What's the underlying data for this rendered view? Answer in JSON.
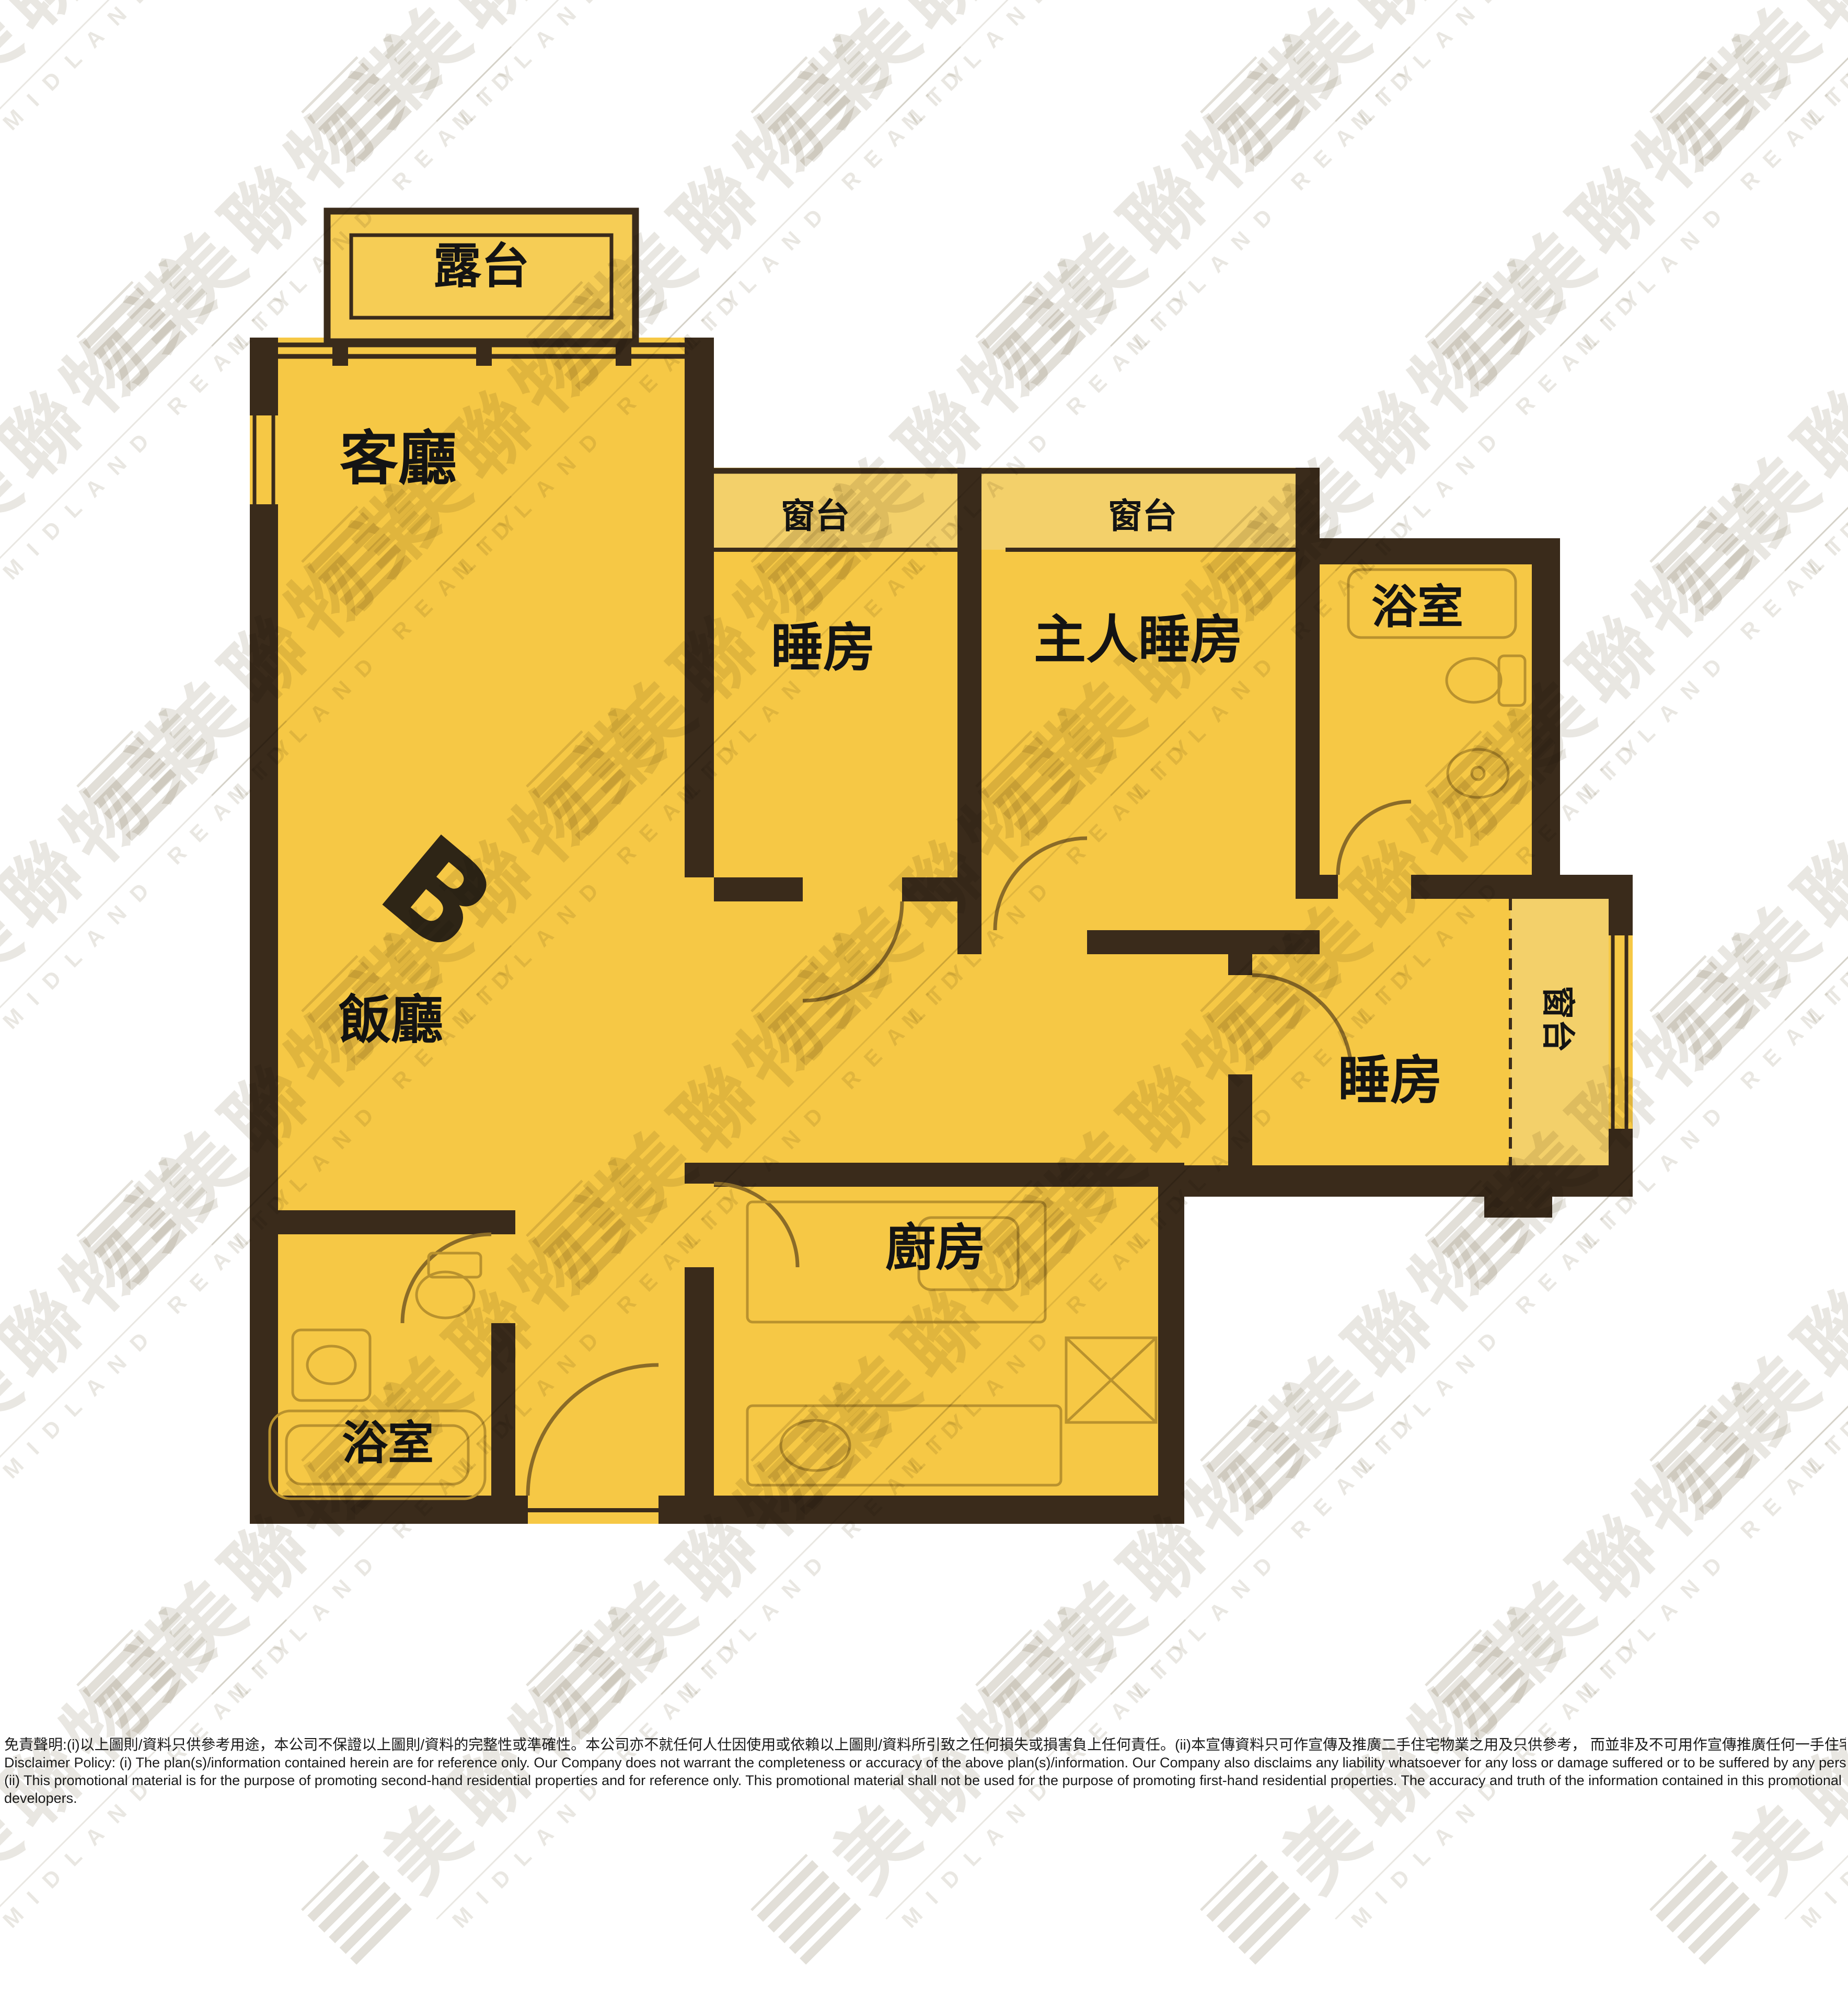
{
  "watermark": {
    "cn": "美聯物業",
    "en": "MIDLAND REALTY"
  },
  "plan_labels": {
    "balcony": "露台",
    "living": "客廳",
    "bay_window_left": "窗台",
    "bay_window_middle": "窗台",
    "bedroom_1": "睡房",
    "master_bedroom": "主人睡房",
    "bathroom_upper": "浴室",
    "unit": "B",
    "dining": "飯廳",
    "bedroom_2": "睡房",
    "bay_window_right": "窗台",
    "kitchen": "廚房",
    "bathroom_lower": "浴室"
  },
  "disclaimer": {
    "zh": "免責聲明:(i)以上圖則/資料只供參考用途，本公司不保證以上圖則/資料的完整性或準確性。本公司亦不就任何人仕因使用或依賴以上圖則/資料所引致之任何損失或損害負上任何責任。(ii)本宣傳資料只可作宣傳及推廣二手住宅物業之用及只供參考， 而並非及不可用作宣傳推廣任何一手住宅物業，其準確性及真實性以樓盤發展商提供的資料為準。",
    "en_1": "Disclaimer Policy: (i) The plan(s)/information contained herein are for reference only. Our Company does not warrant the completeness or accuracy of the above plan(s)/information. Our Company also disclaims any liability whatsoever for any loss or damage suffered or to be suffered by any person as a result of using or relying on the plan(s)/information.",
    "en_2": "(ii) This promotional material is for the purpose of promoting second-hand residential properties and for reference only. This promotional material shall not be used for the purpose of promoting first-hand residential properties. The accuracy and truth of the information contained in this promotional material shall be subject to information provided by the",
    "en_3": "developers."
  },
  "colors": {
    "plan_yellow": "#F6C845",
    "bay_window_yellow": "#F3D06A",
    "wall_brown": "#3A2B1B",
    "door_arc_brown": "#8A6B28",
    "fixture_line": "#B9922E",
    "label_black": "#141414"
  }
}
